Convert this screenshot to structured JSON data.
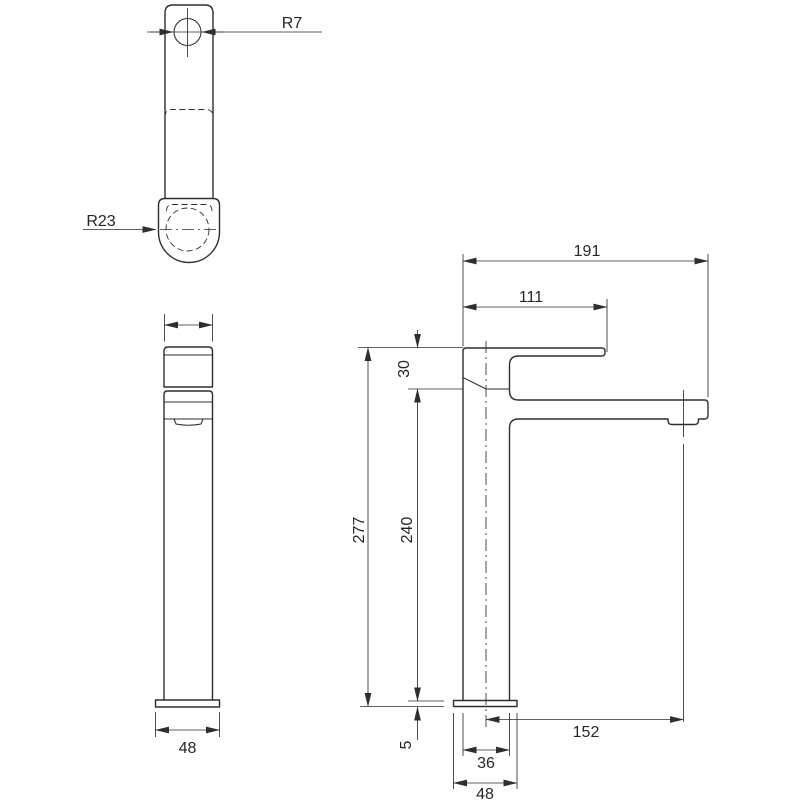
{
  "colors": {
    "line": "#2e2e2e",
    "background": "#ffffff"
  },
  "top_view": {
    "hole_radius_label": "R7",
    "collar_radius_label": "R23"
  },
  "front_view": {
    "base_width_label": "48"
  },
  "side_view": {
    "overall_depth_label": "191",
    "spout_reach_label": "111",
    "handle_section_height_label": "30",
    "total_height_label": "277",
    "column_height_label": "240",
    "aerator_offset_label": "152",
    "base_plate_thickness_label": "5",
    "shank_width_label": "36",
    "base_width_label": "48"
  }
}
